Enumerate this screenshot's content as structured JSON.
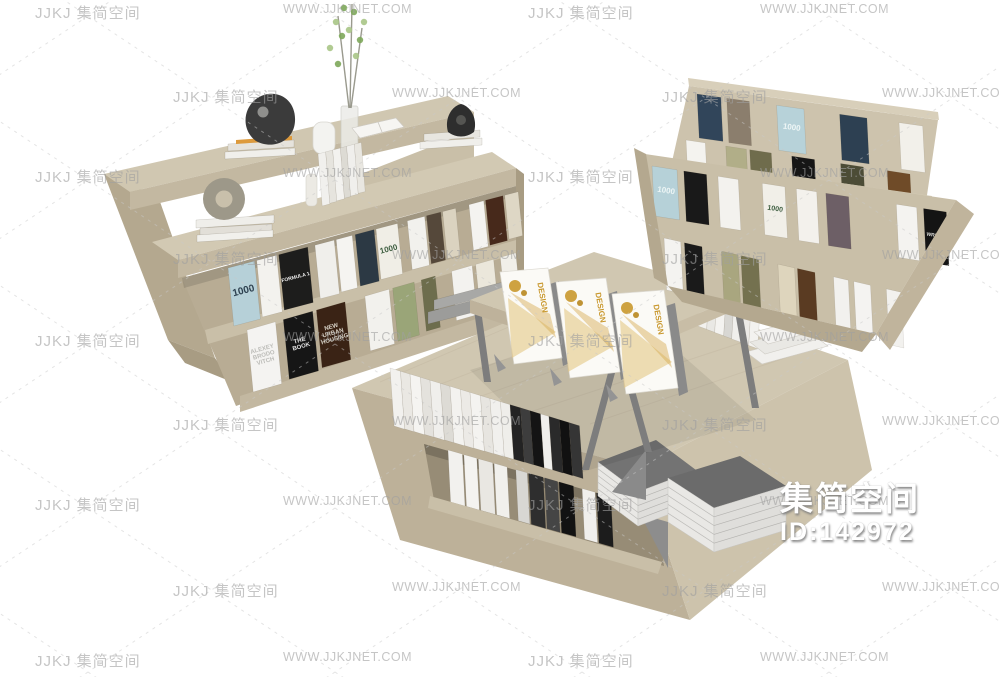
{
  "page": {
    "width": 1000,
    "height": 677,
    "background": "#ffffff"
  },
  "watermark": {
    "brand": "JJKJ 集简空间",
    "site": "WWW.JJKJNET.COM",
    "text_color": "#a0a0a0",
    "line_color": "#c8c8c8"
  },
  "badge": {
    "brand": "集简空间",
    "id": "ID:142972",
    "text_color": "#ffffff"
  },
  "palette": {
    "wood_top": "#d0c7b1",
    "wood_top2": "#d2c9b3",
    "wood_face": "#c3b8a1",
    "wood_mid": "#c9bfa8",
    "wood_side": "#b4a88f",
    "wood_dark": "#a89c83",
    "wood_inner": "#b8ac94",
    "metal_gray": "#7d7d7d",
    "stack_gray": "#737373",
    "stack_gray2": "#6b6b6b",
    "page_white": "#eceae6",
    "card_white": "#fbfaf6",
    "card_gold": "#c9982e",
    "card_gold_light": "#e2c37a",
    "plant_green": "#7da75a",
    "plant_green2": "#a9c586",
    "sculpture_black": "#3b3b3b"
  },
  "left_shelf": {
    "label": "double-sided wood display bookshelf",
    "decor": [
      "black abstract sculpture on book stack",
      "orange pencil tray",
      "white ceramic jar",
      "glass vase with green branches",
      "open white book",
      "white book stack with black shell bowl",
      "stone ring sculpture on white book stack",
      "standing white books"
    ],
    "upper_books": [
      {
        "c": "#b6d0d8",
        "w": 1.25,
        "g": 0.1,
        "label": "1000",
        "lc": "#2e4150",
        "fs": 10
      },
      {
        "c": "#f3f2ee",
        "w": 0.95,
        "g": 0.1
      },
      {
        "c": "#1d1d1c",
        "w": 1.4,
        "g": 0.35,
        "label": "FORMULA 1",
        "lc": "#efefef",
        "fs": 5
      },
      {
        "c": "#f0efeb",
        "w": 0.95,
        "g": 0.1
      },
      {
        "c": "#f5f4f1",
        "w": 0.8,
        "g": 0.15
      },
      {
        "c": "#2c3944",
        "w": 0.95,
        "g": 0.1
      },
      {
        "c": "#f0eee6",
        "w": 1.1,
        "g": 0.5,
        "label": "1000",
        "lc": "#3e5e40",
        "fs": 8
      },
      {
        "c": "#f2f1ed",
        "w": 0.9,
        "g": 0.1
      },
      {
        "c": "#55483a",
        "w": 0.75,
        "g": 0.1
      },
      {
        "c": "#dbd3c0",
        "w": 0.7,
        "g": 0.7
      },
      {
        "c": "#f4f3f0",
        "w": 0.8,
        "g": 0.1
      },
      {
        "c": "#47291b",
        "w": 0.95,
        "g": 0.1
      },
      {
        "c": "#ded7c5",
        "w": 0.75
      }
    ],
    "lower_books": [
      {
        "c": "#f4f3f1",
        "w": 1.1,
        "g": 0.3,
        "label": "ALEXEY\nBRODO\nVITCH",
        "lc": "#bcbcb8",
        "fs": 6
      },
      {
        "c": "#161616",
        "w": 1.15,
        "g": 0.15,
        "label": "THE\nBOOK",
        "lc": "#e6e6e6",
        "fs": 6
      },
      {
        "c": "#3a2315",
        "w": 1.15,
        "g": 0.8,
        "label": "NEW\nURBAN\nHOUSING",
        "lc": "#d9d4c9",
        "fs": 6
      },
      {
        "c": "#f2f1ed",
        "w": 1.0,
        "g": 0.15
      },
      {
        "c": "#9aa578",
        "w": 0.9,
        "g": 0.3
      },
      {
        "c": "#6d6d4d",
        "w": 0.6,
        "g": 0.7
      },
      {
        "c": "#f3f2ef",
        "w": 0.9,
        "g": 0.15
      },
      {
        "c": "#ebe7db",
        "w": 0.8,
        "g": 0.3
      },
      {
        "c": "#f1efe9",
        "w": 0.7
      }
    ],
    "mid_slab_books": [
      {
        "c": "#f1f0ed",
        "w": 1
      },
      {
        "c": "#e6e4de",
        "w": 0.9
      },
      {
        "c": "#f3f2ef",
        "w": 1
      },
      {
        "c": "#dddbd4",
        "w": 0.8
      },
      {
        "c": "#f0efec",
        "w": 1
      },
      {
        "c": "#e9e7e1",
        "w": 0.9
      }
    ]
  },
  "display_rack": {
    "label": "tiered wood display rack",
    "tier1_row1": [
      {
        "c": "#31455a",
        "w": 1.0,
        "g": 0.25
      },
      {
        "c": "#8b7e6d",
        "w": 0.95,
        "g": 1.15
      },
      {
        "c": "#b7d2d9",
        "w": 1.15,
        "g": 1.5,
        "label": "1000",
        "lc": "#eef6f6",
        "fs": 8
      },
      {
        "c": "#2d4052",
        "w": 1.15,
        "g": 1.35
      },
      {
        "c": "#f2f0ea",
        "w": 1.0
      }
    ],
    "tier1_row2": [
      {
        "c": "#f4f3ef",
        "w": 0.85,
        "g": 0.9
      },
      {
        "c": "#b1ae88",
        "w": 0.9,
        "g": 0.15
      },
      {
        "c": "#6f6c4c",
        "w": 0.95,
        "g": 0.9
      },
      {
        "c": "#161616",
        "w": 1.0,
        "g": 1.15
      },
      {
        "c": "#4c4c36",
        "w": 1.0,
        "g": 1.05,
        "label": "WRIGHT",
        "lc": "#e8e8e2",
        "fs": 5
      },
      {
        "c": "#6f4b28",
        "w": 1.0
      }
    ],
    "tier2_row1": [
      {
        "c": "#b6d1d8",
        "w": 1.1,
        "g": 0.3,
        "label": "1000",
        "lc": "#eef6f6",
        "fs": 8
      },
      {
        "c": "#191919",
        "w": 1.0,
        "g": 0.5
      },
      {
        "c": "#f3f2ee",
        "w": 0.9,
        "g": 1.05
      },
      {
        "c": "#f1efe8",
        "w": 1.0,
        "g": 0.5,
        "label": "1000",
        "lc": "#3e5e40",
        "fs": 7
      },
      {
        "c": "#f3f1ec",
        "w": 0.9,
        "g": 0.4
      },
      {
        "c": "#6d5f66",
        "w": 1.0,
        "g": 2.1
      },
      {
        "c": "#f4f3f0",
        "w": 0.9,
        "g": 0.3
      },
      {
        "c": "#141414",
        "w": 1.0,
        "label": "WRIGHT",
        "lc": "#dcdcd8",
        "fs": 5
      }
    ],
    "tier2_row2": [
      {
        "c": "#f4f3f0",
        "w": 0.9,
        "g": 0.2
      },
      {
        "c": "#1a1a1a",
        "w": 0.95,
        "g": 1.05
      },
      {
        "c": "#a9a67f",
        "w": 0.9,
        "g": 0.15
      },
      {
        "c": "#74714f",
        "w": 0.95,
        "g": 1.05
      },
      {
        "c": "#ded5bd",
        "w": 0.9,
        "g": 0.15
      },
      {
        "c": "#5a3b22",
        "w": 0.95,
        "g": 1.0
      },
      {
        "c": "#f2f1ee",
        "w": 0.8,
        "g": 0.3
      },
      {
        "c": "#f4f3f1",
        "w": 0.9,
        "g": 0.85
      },
      {
        "c": "#f2f1ee",
        "w": 0.8
      }
    ]
  },
  "table": {
    "label": "low wood display table with raised tier",
    "cards": [
      {
        "label": "DESIGN"
      },
      {
        "label": "DESIGN"
      },
      {
        "label": "DESIGN"
      }
    ],
    "top_books": [
      {
        "c": "#f2f1ee",
        "w": 1
      },
      {
        "c": "#eae8e3",
        "w": 0.9
      },
      {
        "c": "#f5f4f1",
        "w": 1
      },
      {
        "c": "#e4e2dd",
        "w": 0.9
      },
      {
        "c": "#f0efec",
        "w": 1
      },
      {
        "c": "#dddbd5",
        "w": 0.9
      },
      {
        "c": "#f3f2ef",
        "w": 1
      },
      {
        "c": "#eceae6",
        "w": 0.9
      },
      {
        "c": "#f4f3f0",
        "w": 1
      },
      {
        "c": "#e7e5e0",
        "w": 0.9
      },
      {
        "c": "#f1f0ed",
        "w": 1
      },
      {
        "c": "#efeeea",
        "w": 0.9
      },
      {
        "c": "#232323",
        "w": 1
      },
      {
        "c": "#3d3d3d",
        "w": 0.9
      },
      {
        "c": "#141414",
        "w": 1
      },
      {
        "c": "#f0efec",
        "w": 0.8
      },
      {
        "c": "#2a2a2a",
        "w": 1
      },
      {
        "c": "#111111",
        "w": 0.9
      },
      {
        "c": "#353535",
        "w": 1
      }
    ],
    "right_books": [
      {
        "c": "#f2f1ee",
        "w": 1
      },
      {
        "c": "#e9e8e4",
        "w": 0.9
      },
      {
        "c": "#f4f3f0",
        "w": 1
      },
      {
        "c": "#d8d7d3",
        "w": 0.9
      },
      {
        "c": "#f0efec",
        "w": 1
      },
      {
        "c": "#eceae6",
        "w": 0.9
      },
      {
        "c": "#f3f2ef",
        "w": 1
      }
    ],
    "niche_books": [
      {
        "c": "#f2f1ee",
        "w": 1,
        "g": 0.1
      },
      {
        "c": "#f4f3f0",
        "w": 0.9,
        "g": 0.1
      },
      {
        "c": "#e9e7e2",
        "w": 1,
        "g": 0.1
      },
      {
        "c": "#f1f0ec",
        "w": 0.9,
        "g": 0.6
      },
      {
        "c": "#d8d7d3",
        "w": 0.8,
        "g": 0.1
      },
      {
        "c": "#2e2e2e",
        "w": 1,
        "g": 0.1
      },
      {
        "c": "#454545",
        "w": 0.9,
        "g": 0.1
      },
      {
        "c": "#121212",
        "w": 1,
        "g": 0.6
      },
      {
        "c": "#f0efec",
        "w": 0.9,
        "g": 0.1
      },
      {
        "c": "#1c1c1c",
        "w": 1
      }
    ],
    "gray_stack_count": 2
  }
}
